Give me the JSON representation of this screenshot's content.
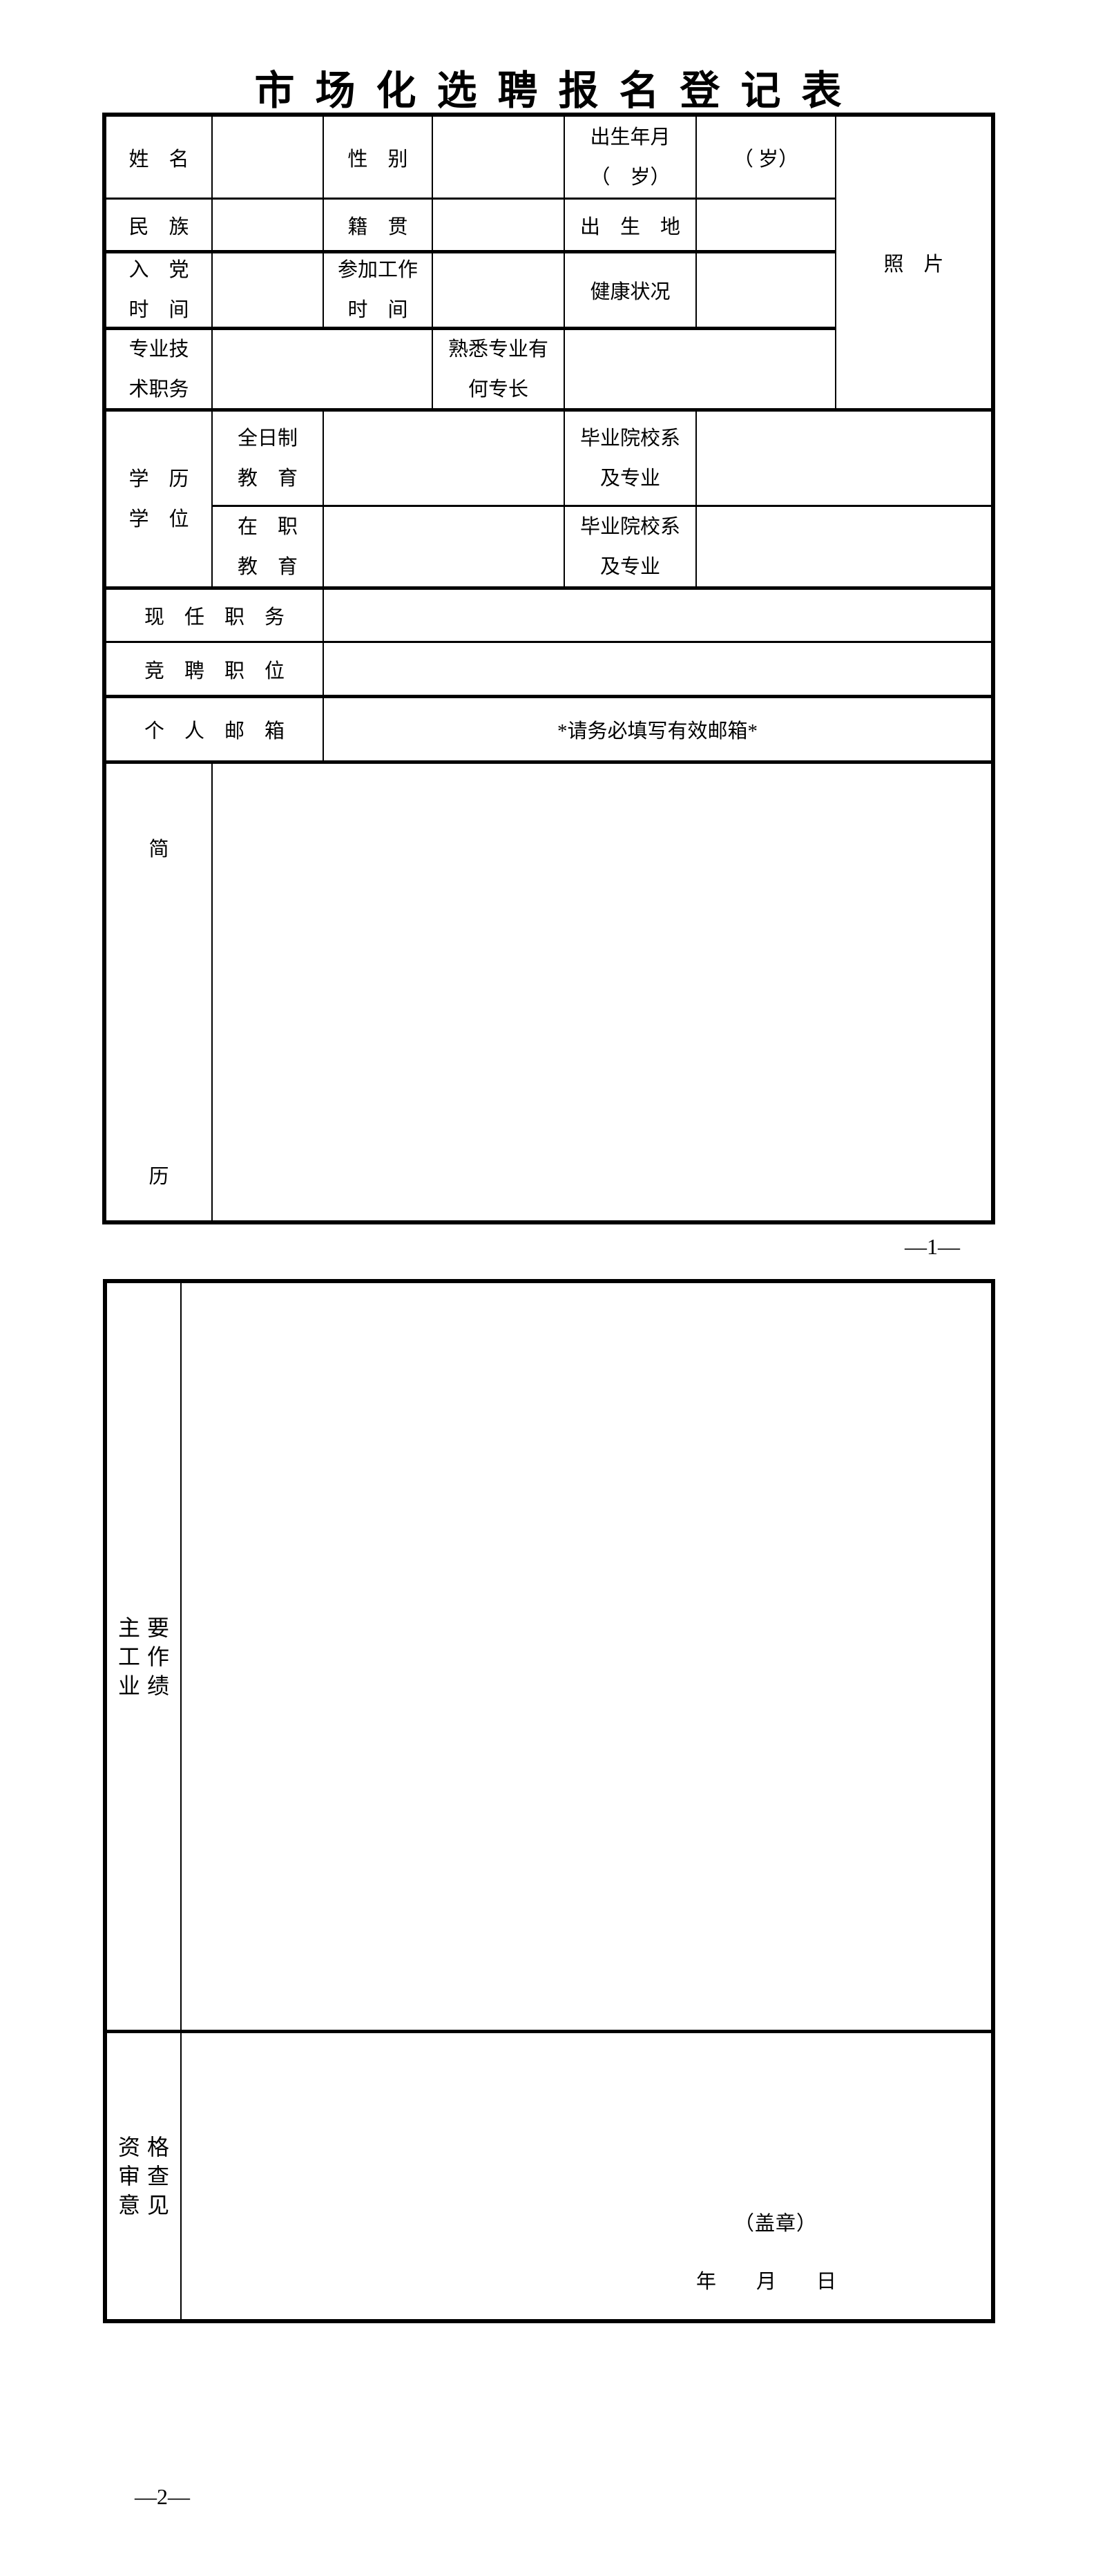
{
  "title": "市场化选聘报名登记表",
  "t1": {
    "name": "姓　名",
    "gender": "性　别",
    "birth": "出生年月\n（　岁）",
    "birth_unit": "（ 岁）",
    "photo": "照　片",
    "ethnic": "民　族",
    "native": "籍　贯",
    "birthplace": "出　生　地",
    "party": "入　党\n时　间",
    "joinwork": "参加工作\n时　间",
    "health": "健康状况",
    "prof": "专业技\n术职务",
    "specialty": "熟悉专业有\n何专长",
    "edu": "学　历\n学　位",
    "fulltime": "全日制\n教　育",
    "onjob": "在　职\n教　育",
    "school1": "毕业院校系\n及专业",
    "school2": "毕业院校系\n及专业",
    "current_post": "现　任　职　务",
    "target_post": "竞　聘　职　位",
    "email": "个　人　邮　箱",
    "email_note": "*请务必填写有效邮箱*",
    "resume_top": "简",
    "resume_bottom": "历"
  },
  "footer1": "—1—",
  "t2": {
    "achievements": "主要\n工作\n业绩",
    "qualification": "资格\n审查\n意见",
    "seal": "（盖章）",
    "date": "年　　月　　日"
  },
  "footer2": "—2—",
  "colors": {
    "ink": "#000000",
    "paper": "#ffffff"
  }
}
